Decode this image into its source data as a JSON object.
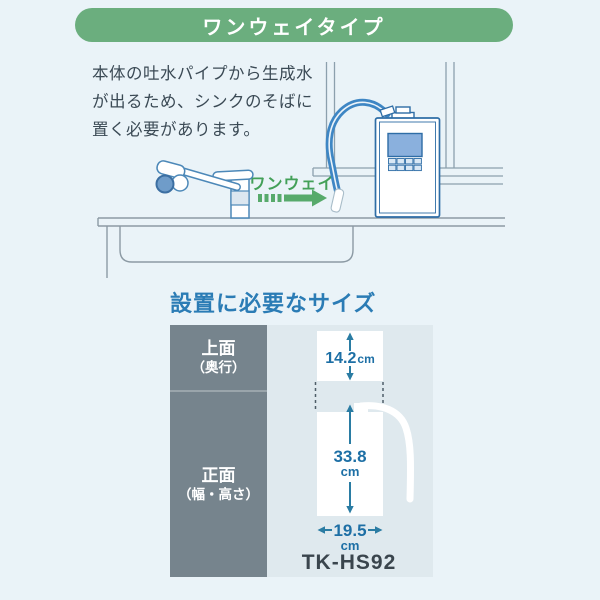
{
  "banner": {
    "label": "ワンウェイタイプ",
    "bg": "#6bae7e"
  },
  "intro": {
    "line1": "本体の吐水パイプから生成水",
    "line2": "が出るため、シンクのそばに",
    "line3": "置く必要があります。"
  },
  "illustration": {
    "flow_label": "ワンウェイ",
    "arrow_color": "#57aa6b",
    "hose_color": "#3e86c4",
    "line_color": "#8c9aa4"
  },
  "size_section": {
    "heading": "設置に必要なサイズ",
    "rows": [
      {
        "label": "上面",
        "sublabel": "（奥行）"
      },
      {
        "label": "正面",
        "sublabel": "（幅・高さ）"
      }
    ],
    "dimensions": {
      "depth_value": "14.2",
      "depth_unit": "cm",
      "height_value": "33.8",
      "height_unit": "cm",
      "width_value": "19.5",
      "width_unit": "cm"
    },
    "model": "TK-HS92",
    "label_bg": "#76848d",
    "cell_bg": "#dfe9ee",
    "dim_color": "#1d6fa5",
    "heading_color": "#2b7cb5"
  }
}
